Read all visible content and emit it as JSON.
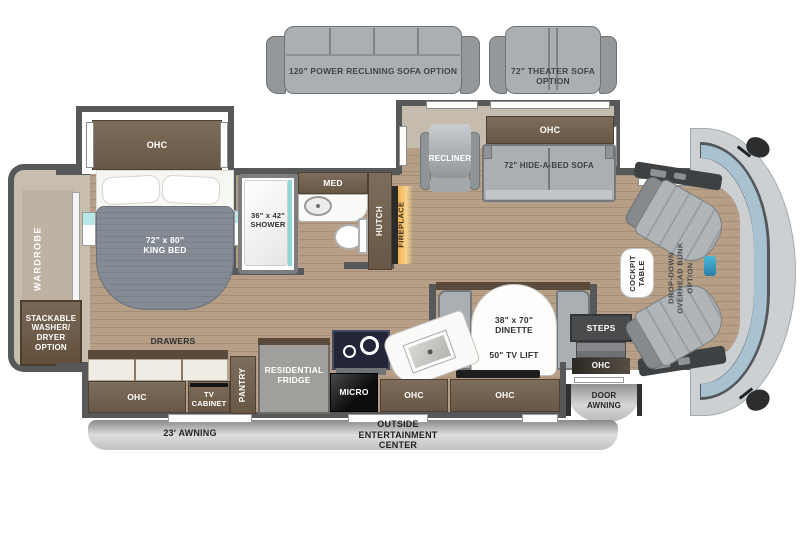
{
  "options": {
    "power_sofa": "120\" POWER RECLINING SOFA OPTION",
    "theater_sofa": "72\" THEATER SOFA\nOPTION"
  },
  "bedroom": {
    "ohc": "OHC",
    "king_bed": "72\" x 80\"\nKING BED",
    "wardrobe": "WARDROBE",
    "washer_dryer": "STACKABLE\nWASHER/\nDRYER\nOPTION",
    "drawers": "DRAWERS"
  },
  "bath": {
    "shower": "36\" x 42\"\nSHOWER",
    "med": "MED",
    "hutch": "HUTCH"
  },
  "living": {
    "fireplace": "FIREPLACE",
    "recliner": "RECLINER",
    "ohc": "OHC",
    "hide_a_bed": "72\" HIDE-A-BED SOFA"
  },
  "kitchen": {
    "ohc_left": "OHC",
    "tv_cabinet": "TV\nCABINET",
    "pantry": "PANTRY",
    "fridge": "RESIDENTIAL\nFRIDGE",
    "micro": "MICRO",
    "ohc_mid": "OHC",
    "ohc_right": "OHC"
  },
  "dinette": {
    "size": "38\" x 70\"\nDINETTE",
    "tv_lift": "50\" TV LIFT"
  },
  "entry": {
    "steps": "STEPS",
    "ohc": "OHC",
    "door_awning": "DOOR\nAWNING"
  },
  "cockpit": {
    "table": "COCKPIT\nTABLE",
    "bunk_option": "DROP-DOWN\nOVERHEAD BUNK\nOPTION"
  },
  "exterior": {
    "awning": "23' AWNING",
    "entertainment": "OUTSIDE\nENTERTAINMENT\nCENTER"
  },
  "colors": {
    "wall": "#57585a",
    "floor_wood": "#b69f86",
    "cabinet_brown": "#6e5d4b",
    "fireplace_orange": "#f5b14e",
    "windshield_blue": "#a9c2d2",
    "sofa_gray": "#aaafb3",
    "shower_teal": "#8fd8d8"
  }
}
